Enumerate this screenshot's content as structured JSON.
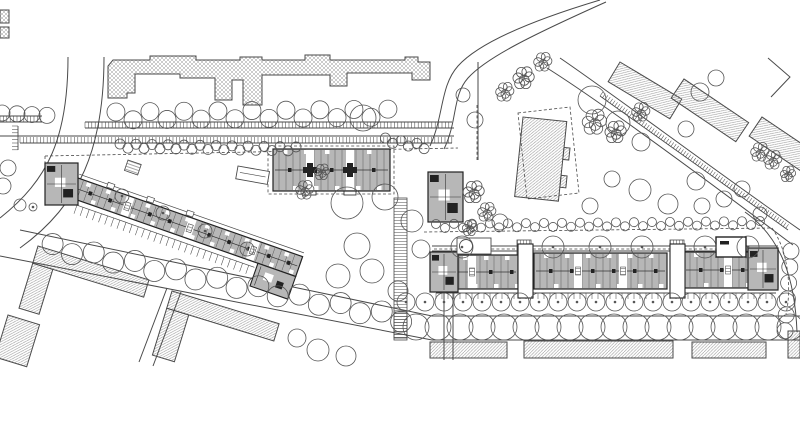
{
  "meta": {
    "drawing_type": "architectural-site-plan",
    "width": 800,
    "height": 437
  },
  "colors": {
    "paper": "#ffffff",
    "line": "#4a4a4a",
    "dark": "#222222",
    "building_gray": "#b7b7b7",
    "hatch": "#8e8e8e",
    "hatch_cross": "#9a9a9a",
    "tree": "#555555"
  },
  "plan": {
    "hatched": [
      {
        "name": "context-building-north",
        "pattern": "cross",
        "polys": [
          [
            [
              108,
              98
            ],
            [
              108,
              66
            ],
            [
              113,
              60
            ],
            [
              150,
              60
            ],
            [
              150,
              56
            ],
            [
              196,
              56
            ],
            [
              196,
              60
            ],
            [
              240,
              60
            ],
            [
              240,
              57
            ],
            [
              262,
              57
            ],
            [
              262,
              60
            ],
            [
              305,
              60
            ],
            [
              305,
              55
            ],
            [
              330,
              55
            ],
            [
              330,
              60
            ],
            [
              405,
              60
            ],
            [
              405,
              57
            ],
            [
              418,
              57
            ],
            [
              418,
              62
            ],
            [
              430,
              62
            ],
            [
              430,
              80
            ],
            [
              412,
              80
            ],
            [
              412,
              73
            ],
            [
              347,
              73
            ],
            [
              347,
              86
            ],
            [
              330,
              86
            ],
            [
              330,
              75
            ],
            [
              262,
              75
            ],
            [
              262,
              105
            ],
            [
              243,
              105
            ],
            [
              243,
              80
            ],
            [
              232,
              80
            ],
            [
              232,
              100
            ],
            [
              215,
              100
            ],
            [
              215,
              78
            ],
            [
              180,
              78
            ],
            [
              180,
              74
            ],
            [
              135,
              74
            ],
            [
              135,
              93
            ],
            [
              127,
              93
            ],
            [
              127,
              98
            ]
          ]
        ]
      },
      {
        "name": "context-building-edge-a",
        "pattern": "cross",
        "rects": [
          [
            0,
            10,
            9,
            13
          ]
        ]
      },
      {
        "name": "context-building-edge-b",
        "pattern": "cross",
        "rects": [
          [
            0,
            27,
            9,
            11
          ]
        ]
      },
      {
        "name": "context-building-center",
        "pattern": "diag",
        "origin": [
          523,
          117
        ],
        "rot": 6,
        "rects": [
          [
            0,
            0,
            44,
            80
          ],
          [
            44,
            26,
            6,
            12
          ],
          [
            44,
            54,
            6,
            12
          ]
        ]
      },
      {
        "name": "context-bar-ne-1",
        "pattern": "diag",
        "origin": [
          620,
          62
        ],
        "rot": 31,
        "rects": [
          [
            0,
            0,
            72,
            23
          ]
        ]
      },
      {
        "name": "context-bar-ne-2",
        "pattern": "diag",
        "origin": [
          684,
          79
        ],
        "rot": 34,
        "rects": [
          [
            0,
            0,
            78,
            23
          ]
        ]
      },
      {
        "name": "context-bar-ne-3",
        "pattern": "diag",
        "origin": [
          762,
          117
        ],
        "rot": 34,
        "rects": [
          [
            0,
            0,
            72,
            23
          ]
        ]
      },
      {
        "name": "context-l-building-sw-1",
        "pattern": "diag",
        "origin": [
          38,
          246
        ],
        "rot": 17,
        "rects": [
          [
            0,
            0,
            116,
            18
          ],
          [
            0,
            18,
            21,
            47
          ]
        ]
      },
      {
        "name": "context-building-sw-small",
        "pattern": "diag",
        "origin": [
          8,
          315
        ],
        "rot": 17,
        "rects": [
          [
            0,
            0,
            33,
            44
          ]
        ]
      },
      {
        "name": "context-l-building-sw-2",
        "pattern": "diag",
        "origin": [
          172,
          291
        ],
        "rot": 17,
        "rects": [
          [
            0,
            0,
            112,
            18
          ],
          [
            0,
            18,
            23,
            49
          ]
        ]
      },
      {
        "name": "context-building-south-1",
        "pattern": "diag",
        "rects": [
          [
            430,
            342,
            77,
            16
          ]
        ]
      },
      {
        "name": "context-building-south-2",
        "pattern": "diag",
        "rects": [
          [
            524,
            341,
            149,
            17
          ]
        ]
      },
      {
        "name": "context-building-south-3",
        "pattern": "diag",
        "rects": [
          [
            692,
            342,
            74,
            16
          ]
        ]
      },
      {
        "name": "context-building-se-edge",
        "pattern": "diag",
        "rects": [
          [
            788,
            331,
            12,
            27
          ]
        ]
      }
    ],
    "strokes": [
      {
        "name": "road-west-left",
        "d": "M68,57 C68,138 48,180 0,218"
      },
      {
        "name": "road-west-right",
        "d": "M104,57 C104,148 80,205 20,248"
      },
      {
        "name": "street-north-edge-1",
        "d": "M85,128 H454"
      },
      {
        "name": "street-north-edge-2",
        "d": "M0,136 H454"
      },
      {
        "name": "street-north-edge-3",
        "d": "M0,122 H42"
      },
      {
        "name": "road-branch-a",
        "d": "M430,146 C444,116 440,86 458,66 C476,46 520,24 600,0"
      },
      {
        "name": "road-branch-b",
        "d": "M444,149 C458,120 452,96 468,78 C486,58 530,36 606,2"
      },
      {
        "name": "road-ne-a",
        "d": "M560,58 C610,92 706,164 800,230"
      },
      {
        "name": "road-ne-b",
        "d": "M547,68 C598,100 696,172 793,245"
      },
      {
        "name": "road-ne-corner",
        "d": "M768,58 L790,77 L771,97"
      },
      {
        "name": "path-vertical-center",
        "d": "M478,62 V160"
      },
      {
        "name": "street-south-upper",
        "d": "M20,230 L432,316 H800"
      },
      {
        "name": "street-south-lower",
        "d": "M0,256 L432,340 H800"
      },
      {
        "name": "street-side-sw-a",
        "d": "M167,288 L139,362"
      },
      {
        "name": "street-side-sw-b",
        "d": "M181,292 L153,366"
      },
      {
        "name": "path-south-a",
        "d": "M444,293 V360"
      },
      {
        "name": "path-south-b",
        "d": "M453,293 V360"
      },
      {
        "name": "gallery-east-a",
        "d": "M432,246 H778"
      },
      {
        "name": "gallery-east-b",
        "d": "M432,251 H778"
      },
      {
        "name": "road-se-curve",
        "d": "M745,212 C782,238 795,280 797,332"
      }
    ],
    "dashes": [
      {
        "name": "site-boundary-north",
        "d": "M45,156 L458,148"
      },
      {
        "name": "site-boundary-west",
        "d": "M45,156 V206"
      },
      {
        "name": "site-boundary-center",
        "d": "M477,105 V162"
      },
      {
        "name": "site-boundary-east-top",
        "d": "M424,232 L772,228"
      },
      {
        "name": "site-boundary-east-curve",
        "d": "M772,228 C788,250 792,288 786,314"
      },
      {
        "name": "gallery-east-dashed",
        "d": "M434,249 H775"
      },
      {
        "name": "boundary-center-building",
        "d": "M518,113 L570,107 L579,193 L527,199 Z"
      },
      {
        "name": "boundary-mid-slab",
        "d": "M268,146 H394 V194 H268 Z"
      }
    ],
    "combs": [
      {
        "name": "parking-north-upper",
        "p": [
          85,
          122,
          452,
          122
        ],
        "len": 6,
        "step": 3.4,
        "side": 1
      },
      {
        "name": "parking-north-lower",
        "p": [
          20,
          143,
          452,
          143
        ],
        "len": 6,
        "step": 3.4,
        "side": -1
      },
      {
        "name": "parking-north-left",
        "p": [
          0,
          116,
          42,
          116
        ],
        "len": 6,
        "step": 3.4,
        "side": 1
      },
      {
        "name": "parking-west-edge",
        "p": [
          18,
          126,
          18,
          150
        ],
        "len": 6,
        "step": 3.4,
        "side": 1
      },
      {
        "name": "strip-road-ne",
        "p": [
          600,
          96,
          788,
          230
        ],
        "len": 5,
        "step": 3,
        "side": -1
      },
      {
        "name": "terraces-east-slab",
        "p": [
          436,
          293,
          776,
          293
        ],
        "len": 6,
        "step": 6,
        "side": 1
      }
    ],
    "ladders": [
      {
        "name": "steps-path-center",
        "x": 394,
        "y": 198,
        "w": 13,
        "h": 140,
        "pattern": "steps"
      },
      {
        "name": "steps-path-center-south",
        "x": 394,
        "y": 312,
        "w": 13,
        "h": 28,
        "pattern": "steps"
      },
      {
        "name": "ramp-west-head",
        "x": 128,
        "y": 160,
        "w": 14,
        "h": 11,
        "rot": 19,
        "pattern": "steps"
      },
      {
        "name": "gate-east-1",
        "x": 517,
        "y": 240,
        "w": 14,
        "h": 16,
        "pattern": "vsteps"
      },
      {
        "name": "gate-east-2",
        "x": 670,
        "y": 240,
        "w": 14,
        "h": 16,
        "pattern": "vsteps"
      }
    ],
    "bars": [
      {
        "name": "residential-slab-west",
        "origin": [
          78,
          178
        ],
        "rot": 19.3,
        "x": 78,
        "y": 178,
        "w": 238,
        "h": 21,
        "slots": [
          130,
          196,
          263
        ],
        "sub": [
          [
            276,
            199,
            40,
            24
          ]
        ],
        "comb": {
          "p": [
            86,
            204,
            274,
            204
          ],
          "len": 9,
          "step": 6.5,
          "side": 1
        },
        "gallery": [
          78,
          174,
          316,
          174
        ],
        "stubs": [
          108,
          150,
          192
        ]
      },
      {
        "name": "residential-slab-mid",
        "x": 273,
        "y": 149,
        "w": 117,
        "h": 42,
        "slots": [
          306,
          346
        ],
        "cores": true,
        "bumps": true
      },
      {
        "name": "residential-slab-east-1",
        "x": 432,
        "y": 255,
        "w": 86,
        "h": 34,
        "slots": [
          468
        ]
      },
      {
        "name": "residential-slab-east-2",
        "x": 534,
        "y": 253,
        "w": 133,
        "h": 36,
        "slots": [
          574,
          619
        ]
      },
      {
        "name": "residential-slab-east-3",
        "x": 684,
        "y": 252,
        "w": 94,
        "h": 36,
        "slots": [
          724
        ]
      }
    ],
    "blocks": [
      {
        "name": "head-building-west",
        "x": 45,
        "y": 163,
        "w": 33,
        "h": 42
      },
      {
        "name": "tower-building-center",
        "x": 428,
        "y": 172,
        "w": 35,
        "h": 50
      },
      {
        "name": "head-building-east",
        "x": 748,
        "y": 248,
        "w": 30,
        "h": 42
      },
      {
        "name": "head-building-east-west-end",
        "x": 430,
        "y": 252,
        "w": 28,
        "h": 40
      }
    ],
    "connectors": [
      {
        "name": "stair-connector-1",
        "x": 518,
        "y": 244,
        "w": 15,
        "h": 54
      },
      {
        "name": "stair-connector-2",
        "x": 670,
        "y": 244,
        "w": 15,
        "h": 54
      }
    ],
    "extras": {
      "shed_rect": {
        "x": 238,
        "y": 166,
        "w": 32,
        "h": 13,
        "rot": 10
      },
      "canopy": {
        "x": 457,
        "y": 238,
        "w": 34,
        "h": 16,
        "cx": 466,
        "cy": 246,
        "r": 6.5
      },
      "court": {
        "x": 716,
        "y": 237,
        "w": 30,
        "h": 20,
        "mark": [
          720,
          241,
          9,
          3.5
        ]
      }
    },
    "trees": {
      "chains": [
        {
          "p": [
            2,
            113,
            58,
            116
          ],
          "step": 15,
          "r": 8
        },
        {
          "p": [
            116,
            116,
            398,
            113
          ],
          "step": 17,
          "r": 9,
          "alt": 4
        },
        {
          "p": [
            52,
            247,
            418,
            322
          ],
          "step": 21,
          "r": 10.5,
          "alt": 3
        },
        {
          "p": [
            416,
            327,
            798,
            327
          ],
          "step": 22,
          "r": 13
        },
        {
          "p": [
            406,
            302,
            788,
            302
          ],
          "step": 19,
          "r": 9,
          "dot": true
        },
        {
          "p": [
            791,
            251,
            785,
            331
          ],
          "step": 16,
          "r": 8
        }
      ],
      "bush_chains": [
        {
          "p": [
            120,
            146,
            300,
            149
          ],
          "step": 8,
          "r": 5,
          "alt": 2
        },
        {
          "p": [
            385,
            140,
            432,
            148
          ],
          "step": 8,
          "r": 5,
          "alt": 2
        },
        {
          "p": [
            436,
            226,
            768,
            223
          ],
          "step": 9,
          "r": 4.5,
          "alt": 2
        }
      ],
      "singles": [
        [
          363,
          118,
          13
        ],
        [
          347,
          203,
          16
        ],
        [
          385,
          197,
          13
        ],
        [
          412,
          221,
          11
        ],
        [
          357,
          246,
          13
        ],
        [
          338,
          276,
          12
        ],
        [
          372,
          271,
          12
        ],
        [
          398,
          291,
          10
        ],
        [
          421,
          249,
          9
        ],
        [
          592,
          100,
          14
        ],
        [
          618,
          123,
          12
        ],
        [
          641,
          142,
          9
        ],
        [
          700,
          92,
          9
        ],
        [
          716,
          78,
          8
        ],
        [
          686,
          129,
          8
        ],
        [
          640,
          190,
          11
        ],
        [
          668,
          204,
          10
        ],
        [
          696,
          181,
          9
        ],
        [
          702,
          206,
          8
        ],
        [
          724,
          199,
          8
        ],
        [
          742,
          189,
          8
        ],
        [
          612,
          179,
          8
        ],
        [
          590,
          206,
          8
        ],
        [
          760,
          214,
          7
        ],
        [
          500,
          222,
          8
        ],
        [
          8,
          168,
          8
        ],
        [
          3,
          186,
          8
        ],
        [
          20,
          205,
          6
        ],
        [
          318,
          350,
          11
        ],
        [
          346,
          356,
          10
        ],
        [
          297,
          338,
          9
        ],
        [
          475,
          120,
          8
        ],
        [
          463,
          95,
          7
        ]
      ],
      "dotted": [
        [
          462,
          247,
          11
        ],
        [
          553,
          247,
          11
        ],
        [
          600,
          247,
          11
        ],
        [
          642,
          247,
          11
        ],
        [
          705,
          247,
          11
        ],
        [
          748,
          247,
          11
        ],
        [
          122,
          196,
          7
        ],
        [
          163,
          213,
          7
        ],
        [
          205,
          231,
          7
        ],
        [
          247,
          249,
          7
        ],
        [
          33,
          207,
          4
        ]
      ],
      "clusters": [
        [
          518,
          78,
          7
        ],
        [
          538,
          62,
          6
        ],
        [
          500,
          92,
          6
        ],
        [
          468,
          192,
          7
        ],
        [
          482,
          212,
          6
        ],
        [
          466,
          228,
          5
        ],
        [
          610,
          132,
          7
        ],
        [
          588,
          122,
          8
        ],
        [
          636,
          112,
          6
        ],
        [
          768,
          160,
          6
        ],
        [
          784,
          174,
          5
        ],
        [
          300,
          190,
          6
        ],
        [
          318,
          172,
          5
        ],
        [
          755,
          152,
          6
        ]
      ]
    }
  }
}
